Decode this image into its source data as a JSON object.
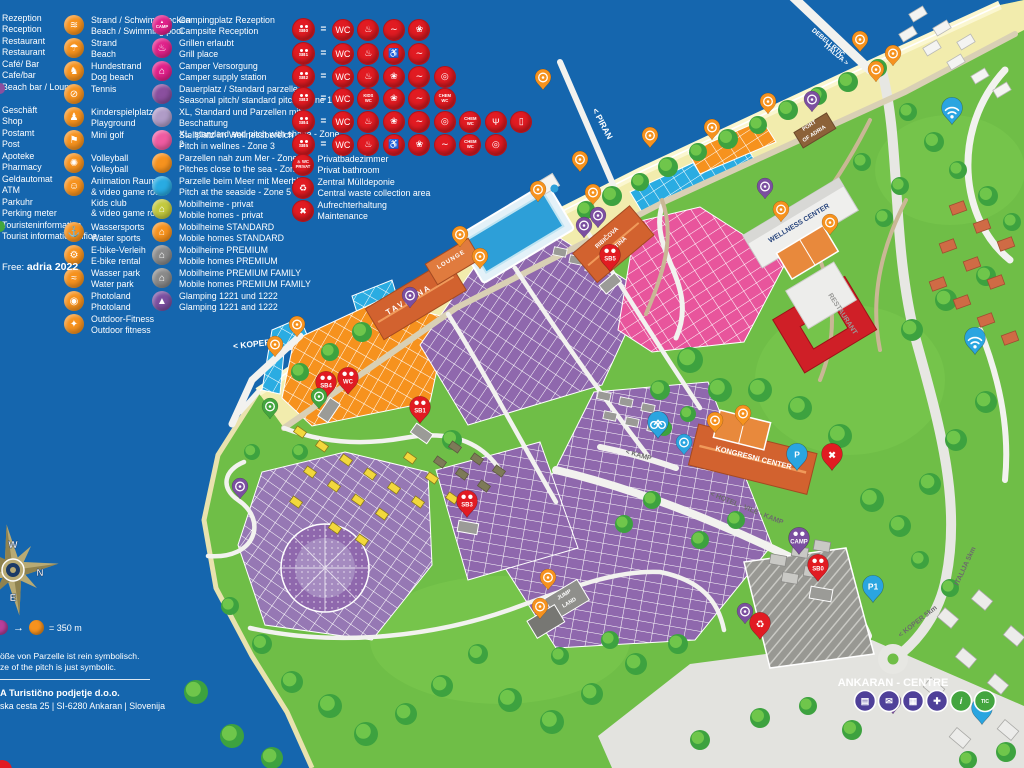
{
  "legend": {
    "services": [
      {
        "de": "Rezeption",
        "en": "Reception"
      },
      {
        "de": "Restaurant",
        "en": "Restaurant"
      },
      {
        "de": "Café/ Bar",
        "en": "Cafe/bar"
      },
      {
        "de": "Beach bar / Lounge",
        "en": ""
      },
      {
        "de": "Geschäft",
        "en": "Shop"
      },
      {
        "de": "Postamt",
        "en": "Post"
      },
      {
        "de": "Apoteke",
        "en": "Pharmacy"
      },
      {
        "de": "Geldautomat",
        "en": "ATM"
      },
      {
        "de": "Parkuhr",
        "en": "Perking meter"
      },
      {
        "de": "Touristeninformation",
        "en": "Tourist information office"
      }
    ],
    "free_label": "Free:",
    "free_value": "adria 2022",
    "activities": [
      {
        "id": "beach-pool",
        "g": "≋",
        "de": "Strand / Schwimmbecken",
        "en": "Beach / Swimming pool"
      },
      {
        "id": "beach-umbrella",
        "g": "☂",
        "de": "Strand",
        "en": "Beach"
      },
      {
        "id": "dog-beach",
        "g": "♞",
        "de": "Hundestrand",
        "en": "Dog  beach"
      },
      {
        "id": "tennis",
        "g": "⊘",
        "de": "Tennis",
        "en": ""
      },
      {
        "id": "playground",
        "g": "♟",
        "de": "Kinderspielplatz",
        "en": "Playground"
      },
      {
        "id": "minigolf",
        "g": "⚑",
        "de": "Mini golf",
        "en": ""
      },
      {
        "id": "volleyball",
        "g": "✺",
        "de": "Volleyball",
        "en": "Volleyball"
      },
      {
        "id": "kids-club",
        "g": "☺",
        "de": "Animation Raum",
        "en": "& video game room",
        "de2": "Kids club",
        "en2": "& video game room"
      },
      {
        "id": "water-sports",
        "g": "⚓",
        "de": "Wassersports",
        "en": "Water sports"
      },
      {
        "id": "e-bike",
        "g": "⚙",
        "de": "E-bike-Verleih",
        "en": "E-bike rental"
      },
      {
        "id": "water-park",
        "g": "≈",
        "de": "Wasser park",
        "en": "Water park"
      },
      {
        "id": "photoland",
        "g": "◉",
        "de": "Photoland",
        "en": "Photoland"
      },
      {
        "id": "outdoor-fitness",
        "g": "✦",
        "de": "Outdoor-Fitness",
        "en": "Outdoor fitness"
      }
    ],
    "accommodation": [
      {
        "id": "camp-reception",
        "color": "#e0218a",
        "g": "CAMP",
        "pin": true,
        "de": "Campingplatz Rezeption",
        "en": "Campsite Reception"
      },
      {
        "id": "grill-place",
        "color": "#e0218a",
        "g": "♨",
        "pin": true,
        "de": "Grillen erlaubt",
        "en": "Grill place"
      },
      {
        "id": "camper-supply",
        "color": "#e0218a",
        "g": "⌂",
        "pin": true,
        "de": "Camper Versorgung",
        "en": "Camper supply station"
      },
      {
        "id": "zone1",
        "color": "#8a4f9e",
        "g": "",
        "de": "Dauerplatz / Standard parzelle",
        "en": "Seasonal pitch/ standard pitch - Zone 1"
      },
      {
        "id": "zone2",
        "color": "#b09cc7",
        "g": "",
        "de": "XL, Standard und Parzellen mit Beschattung",
        "en": "XL, standard and pitch with shade -  Zone 2"
      },
      {
        "id": "zone3",
        "color": "#ef5ba1",
        "g": "",
        "de": "Stellplatz im Wellnessbereich",
        "en": "Pitch in wellnes - Zone 3"
      },
      {
        "id": "zone4",
        "color": "#f6921e",
        "g": "",
        "de": "Parzellen nah zum Mer - Zone 4",
        "en": "Pitches close to the sea - Zone 4"
      },
      {
        "id": "zone5",
        "color": "#29abe2",
        "g": "",
        "de": "Parzelle beim Meer mit Meerblick",
        "en": "Pitch at the seaside - Zone 5"
      },
      {
        "id": "mh-privat",
        "color": "#c3c93e",
        "g": "⌂",
        "de": "Mobilheime - privat",
        "en": "Mobile homes - privat"
      },
      {
        "id": "mh-standard",
        "color": "#f6921e",
        "g": "⌂",
        "de": "Mobilheime STANDARD",
        "en": "Mobile homes STANDARD"
      },
      {
        "id": "mh-premium",
        "color": "#8a8a8a",
        "g": "⌂",
        "de": "Mobilheime PREMIUM",
        "en": "Mobile homes PREMIUM"
      },
      {
        "id": "mh-premium-family",
        "color": "#8a8a8a",
        "g": "⌂",
        "de": "Mobilheime PREMIUM FAMILY",
        "en": "Mobile homes PREMIUM FAMILY"
      },
      {
        "id": "glamping",
        "color": "#7b4fa0",
        "g": "▲",
        "de": "Glamping 1221 und 1222",
        "en": "Glamping 1221 and 1222"
      }
    ],
    "sanitary": {
      "glyphs": {
        "wc": "WC",
        "shower": "♨",
        "wash": "❀",
        "sink": "∼",
        "laundry": "◎",
        "accessible": "♿",
        "kids": "KIDS|WC",
        "chem": "CHEM|WC",
        "dish": "Ψ",
        "fridge": "▯"
      },
      "blocks": [
        {
          "label": "SB0",
          "icons": [
            "wc",
            "shower",
            "sink",
            "wash"
          ]
        },
        {
          "label": "SB1",
          "icons": [
            "wc",
            "shower",
            "accessible",
            "sink"
          ]
        },
        {
          "label": "SB2",
          "icons": [
            "wc",
            "shower",
            "wash",
            "sink",
            "laundry"
          ]
        },
        {
          "label": "SB3",
          "icons": [
            "wc",
            "kids",
            "wash",
            "sink",
            "chem"
          ]
        },
        {
          "label": "SB4",
          "icons": [
            "wc",
            "shower",
            "wash",
            "sink",
            "laundry",
            "chem",
            "dish",
            "fridge"
          ]
        },
        {
          "label": "SB5",
          "icons": [
            "wc",
            "shower",
            "accessible",
            "wash",
            "sink",
            "chem",
            "laundry"
          ]
        }
      ],
      "extras": [
        {
          "id": "private-bathroom",
          "g": "PRIVAT",
          "de": "Privatbadezimmer",
          "en": "Privat bathroom"
        },
        {
          "id": "waste-collection",
          "g": "♻",
          "de": "Zentral Mülldeponie",
          "en": "Central waste collection area"
        },
        {
          "id": "maintenance",
          "g": "✖",
          "de": "Aufrechterhaltung",
          "en": "Maintenance"
        }
      ]
    },
    "scale_text": "= 350 m",
    "disclaimer_de": "öße von Parzelle ist rein symbolisch.",
    "disclaimer_en": "ze of the pitch is just symbolic.",
    "company_name": "A Turistično podjetje d.o.o.",
    "company_address": "ska cesta 25   |   SI-6280 Ankaran   |   Slovenija"
  },
  "compass": {
    "n": "N",
    "e": "E",
    "s": "S",
    "w": "W"
  },
  "map": {
    "labels": [
      {
        "id": "piran",
        "text": "< PIRAN",
        "x": 600,
        "y": 125,
        "rot": 62,
        "size": 8.5,
        "color": "#ffffff",
        "b": true
      },
      {
        "id": "koper",
        "text": "< KOPER",
        "x": 252,
        "y": 347,
        "rot": -6,
        "size": 8.5,
        "color": "#ffffff",
        "b": true
      },
      {
        "id": "debeli-rtic-1",
        "text": "DEBELI RTIČ",
        "x": 827,
        "y": 44,
        "rot": 40,
        "size": 6.5,
        "color": "#ffffff",
        "b": true
      },
      {
        "id": "debeli-rtic-2",
        "text": "ITALIJA >",
        "x": 835,
        "y": 56,
        "rot": 40,
        "size": 6.5,
        "color": "#ffffff",
        "b": true
      },
      {
        "id": "port-of-adria-1",
        "text": "PORT",
        "x": 810,
        "y": 127,
        "rot": -33,
        "size": 5.5,
        "color": "#ffffff",
        "b": true
      },
      {
        "id": "port-of-adria-2",
        "text": "OF ADRIA",
        "x": 815,
        "y": 135,
        "rot": -33,
        "size": 5.5,
        "color": "#ffffff",
        "b": true
      },
      {
        "id": "taverna",
        "text": "TAVERNA",
        "x": 410,
        "y": 302,
        "rot": -31,
        "size": 8,
        "color": "#ffffff",
        "b": true,
        "ls": 2
      },
      {
        "id": "lounge",
        "text": "LOUNGE",
        "x": 452,
        "y": 261,
        "rot": -31,
        "size": 6,
        "color": "#ffffff",
        "b": true,
        "ls": 1
      },
      {
        "id": "kantina-1",
        "text": "RIBIČOVA",
        "x": 608,
        "y": 239,
        "rot": -42,
        "size": 6,
        "color": "#ffffff",
        "b": true
      },
      {
        "id": "kantina-2",
        "text": "KANTINA",
        "x": 617,
        "y": 248,
        "rot": -42,
        "size": 6,
        "color": "#ffffff",
        "b": true
      },
      {
        "id": "wellness-center",
        "text": "WELLNESS CENTER",
        "x": 800,
        "y": 225,
        "rot": -31,
        "size": 7,
        "color": "#27447c",
        "b": true
      },
      {
        "id": "restaurant",
        "text": "RESTAURANT",
        "x": 841,
        "y": 315,
        "rot": 57,
        "size": 7,
        "color": "#9a9a98",
        "b": true
      },
      {
        "id": "kongresni-center",
        "text": "KONGRESNI CENTER",
        "x": 753,
        "y": 460,
        "rot": 14,
        "size": 7.5,
        "color": "#ffffff",
        "b": true
      },
      {
        "id": "kamp-road",
        "text": "< KAMP",
        "x": 638,
        "y": 457,
        "rot": 16,
        "size": 7,
        "color": "#6b6b6b",
        "b": true
      },
      {
        "id": "hotel-vile-kamp-road",
        "text": "< HOTEL - VILE - KAMP",
        "x": 746,
        "y": 510,
        "rot": 22,
        "size": 7,
        "color": "#6b6b6b",
        "b": true
      },
      {
        "id": "jump-land-1",
        "text": "JUMP",
        "x": 565,
        "y": 596,
        "rot": -31,
        "size": 5.5,
        "color": "#ffffff",
        "b": true
      },
      {
        "id": "jump-land-2",
        "text": "LAND",
        "x": 570,
        "y": 604,
        "rot": -31,
        "size": 5.5,
        "color": "#ffffff",
        "b": true
      },
      {
        "id": "ankaran-centre",
        "text": "ANKARAN - CENTRE",
        "x": 893,
        "y": 686,
        "rot": 0,
        "size": 11,
        "color": "#ffffff",
        "b": true
      },
      {
        "id": "koper-5km-road",
        "text": "< KOPER  5km",
        "x": 919,
        "y": 623,
        "rot": -38,
        "size": 7,
        "color": "#6b6b6b",
        "b": true
      },
      {
        "id": "italija-5km-road",
        "text": "ITALIJA  5km",
        "x": 967,
        "y": 567,
        "rot": -65,
        "size": 7,
        "color": "#6b6b6b",
        "b": true
      }
    ],
    "pins": [
      {
        "n": "dog-beach-pin",
        "c": "orange",
        "x": 543,
        "y": 88
      },
      {
        "n": "beach-pin-1",
        "c": "orange",
        "x": 580,
        "y": 170
      },
      {
        "n": "beach-pin-2",
        "c": "orange",
        "x": 650,
        "y": 146
      },
      {
        "n": "grill-pin",
        "c": "orange",
        "x": 712,
        "y": 138
      },
      {
        "n": "water-sports-pin",
        "c": "orange",
        "x": 768,
        "y": 112
      },
      {
        "n": "beach-pin-3",
        "c": "orange",
        "x": 860,
        "y": 50
      },
      {
        "n": "beach-pin-4",
        "c": "orange",
        "x": 876,
        "y": 80
      },
      {
        "n": "dog-beach-pin-2",
        "c": "orange",
        "x": 893,
        "y": 64
      },
      {
        "n": "volleyball-pin",
        "c": "orange",
        "x": 593,
        "y": 203
      },
      {
        "n": "pool-pin",
        "c": "orange",
        "x": 538,
        "y": 200
      },
      {
        "n": "beach-bar-pin",
        "c": "orange",
        "x": 480,
        "y": 267
      },
      {
        "n": "taverna-pin",
        "c": "orange",
        "x": 460,
        "y": 245
      },
      {
        "n": "marina-pin-1",
        "c": "orange",
        "x": 297,
        "y": 335
      },
      {
        "n": "marina-pin-2",
        "c": "orange",
        "x": 275,
        "y": 355
      },
      {
        "n": "wellness-activity-pin",
        "c": "orange",
        "x": 781,
        "y": 220
      },
      {
        "n": "tennis-pin",
        "c": "orange",
        "x": 830,
        "y": 233
      },
      {
        "n": "minigolf-pin",
        "c": "orange",
        "x": 715,
        "y": 431
      },
      {
        "n": "playground-pin",
        "c": "orange",
        "x": 743,
        "y": 424
      },
      {
        "n": "jump-land-pin",
        "c": "orange",
        "x": 548,
        "y": 588
      },
      {
        "n": "outdoor-fitness-pin",
        "c": "orange",
        "x": 540,
        "y": 617
      },
      {
        "n": "sb4-pin",
        "c": "red",
        "l": "SB4",
        "x": 326,
        "y": 396
      },
      {
        "n": "wc-pin",
        "c": "red",
        "l": "WC",
        "x": 348,
        "y": 392
      },
      {
        "n": "sb1-pin",
        "c": "red",
        "l": "SB1",
        "x": 420,
        "y": 421
      },
      {
        "n": "sb3-pin",
        "c": "red",
        "l": "SB3",
        "x": 467,
        "y": 515
      },
      {
        "n": "sb5-pin",
        "c": "red",
        "l": "SB5",
        "x": 610,
        "y": 269
      },
      {
        "n": "sb0-pin",
        "c": "red",
        "l": "SB0",
        "x": 818,
        "y": 579
      },
      {
        "n": "waste-pin",
        "c": "red",
        "g": "recycle",
        "x": 760,
        "y": 637
      },
      {
        "n": "maintenance-pin",
        "c": "red",
        "g": "cross",
        "x": 832,
        "y": 468
      },
      {
        "n": "dj-stage-pin",
        "c": "purple",
        "x": 410,
        "y": 306
      },
      {
        "n": "glamping-1221-pin",
        "c": "purple",
        "x": 584,
        "y": 236
      },
      {
        "n": "glamping-1222-pin",
        "c": "purple",
        "x": 598,
        "y": 226
      },
      {
        "n": "wellness-info-pin",
        "c": "purple",
        "x": 765,
        "y": 197
      },
      {
        "n": "camp-reception-pin",
        "c": "purple",
        "l": "CAMP",
        "x": 799,
        "y": 552
      },
      {
        "n": "port-info-pin",
        "c": "purple",
        "x": 812,
        "y": 110
      },
      {
        "n": "centre-info-pin",
        "c": "purple",
        "x": 893,
        "y": 712
      },
      {
        "n": "big-tent-pin",
        "c": "purple",
        "x": 240,
        "y": 497
      },
      {
        "n": "photoland-pin",
        "c": "purple",
        "x": 745,
        "y": 622
      },
      {
        "n": "wifi-pin-1",
        "c": "blue",
        "g": "wifi",
        "x": 952,
        "y": 122
      },
      {
        "n": "wifi-pin-2",
        "c": "blue",
        "g": "wifi",
        "x": 975,
        "y": 352
      },
      {
        "n": "parking-p1-pin",
        "c": "blue",
        "l": "P1",
        "x": 873,
        "y": 600
      },
      {
        "n": "parking-p-pin",
        "c": "blue",
        "l": "P",
        "x": 982,
        "y": 722
      },
      {
        "n": "parking-kongres-pin",
        "c": "blue",
        "l": "P",
        "x": 797,
        "y": 468
      },
      {
        "n": "e-bike-pin",
        "c": "blue",
        "g": "bike",
        "x": 658,
        "y": 436
      },
      {
        "n": "info-blue-pin",
        "c": "blue",
        "x": 684,
        "y": 453
      },
      {
        "n": "green-pin-1",
        "c": "green",
        "x": 319,
        "y": 407
      },
      {
        "n": "green-pin-2",
        "c": "green",
        "x": 270,
        "y": 417
      }
    ],
    "centre_icons": [
      {
        "n": "atm-icon",
        "g": "▤",
        "c": "#4f4099"
      },
      {
        "n": "post-icon",
        "g": "✉",
        "c": "#4f4099"
      },
      {
        "n": "shop-icon",
        "g": "▦",
        "c": "#4f4099"
      },
      {
        "n": "pharmacy-icon",
        "g": "✚",
        "c": "#4f4099"
      },
      {
        "n": "info-icon",
        "g": "i",
        "c": "#43a53f"
      },
      {
        "n": "tic-icon",
        "g": "TIC",
        "c": "#43a53f"
      }
    ]
  }
}
